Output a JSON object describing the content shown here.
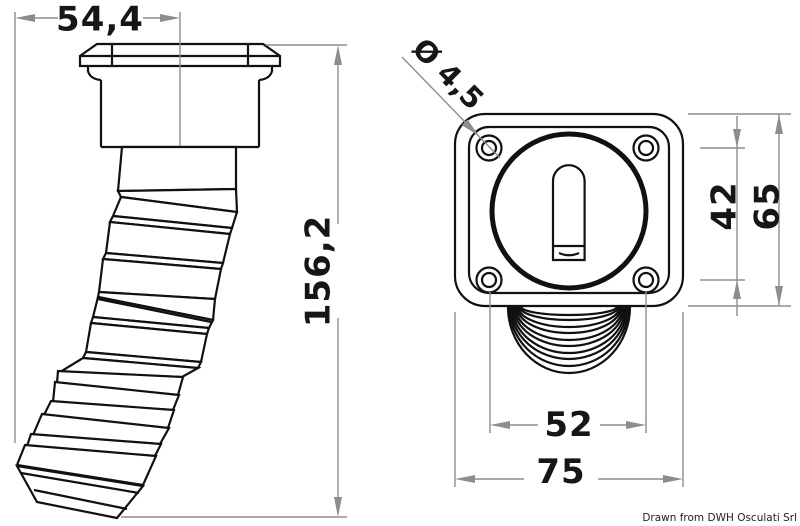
{
  "dimensions": {
    "cap_width": "54,4",
    "overall_height": "156,2",
    "screw_hole_diameter": "Ø 4,5",
    "hole_spacing_vertical": "42",
    "plate_height": "65",
    "hole_spacing_horizontal": "52",
    "plate_width": "75"
  },
  "footer": {
    "attribution": "Drawn from DWH Osculati Srl"
  },
  "colors": {
    "outline": "#111111",
    "dimension_lines": "#8d8d8d",
    "background": "#ffffff"
  }
}
